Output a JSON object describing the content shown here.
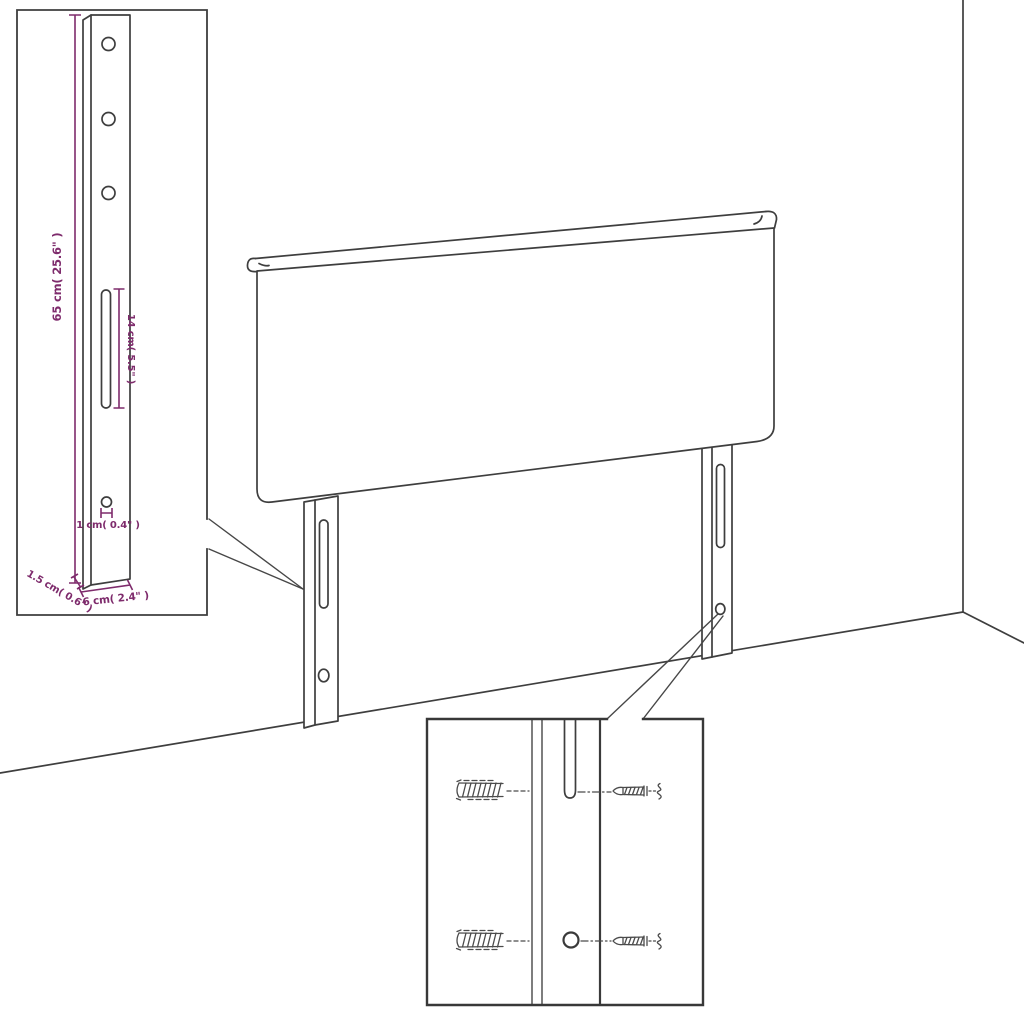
{
  "figure": {
    "kind": "furniture-assembly-line-drawing",
    "text_visible_anywhere_else": false
  },
  "colors": {
    "background": "#ffffff",
    "line_art": "#3e3e3e",
    "dimension_accent": "#7e2b6c"
  },
  "labels": {
    "bracket_height": "65 cm( 25.6\" )",
    "slot_length": "14 cm( 5.5\" )",
    "hole_diameter": "1 cm( 0.4\" )",
    "bracket_depth": "1.5 cm( 0.6\" )",
    "bracket_width": "6 cm( 2.4\" )"
  }
}
